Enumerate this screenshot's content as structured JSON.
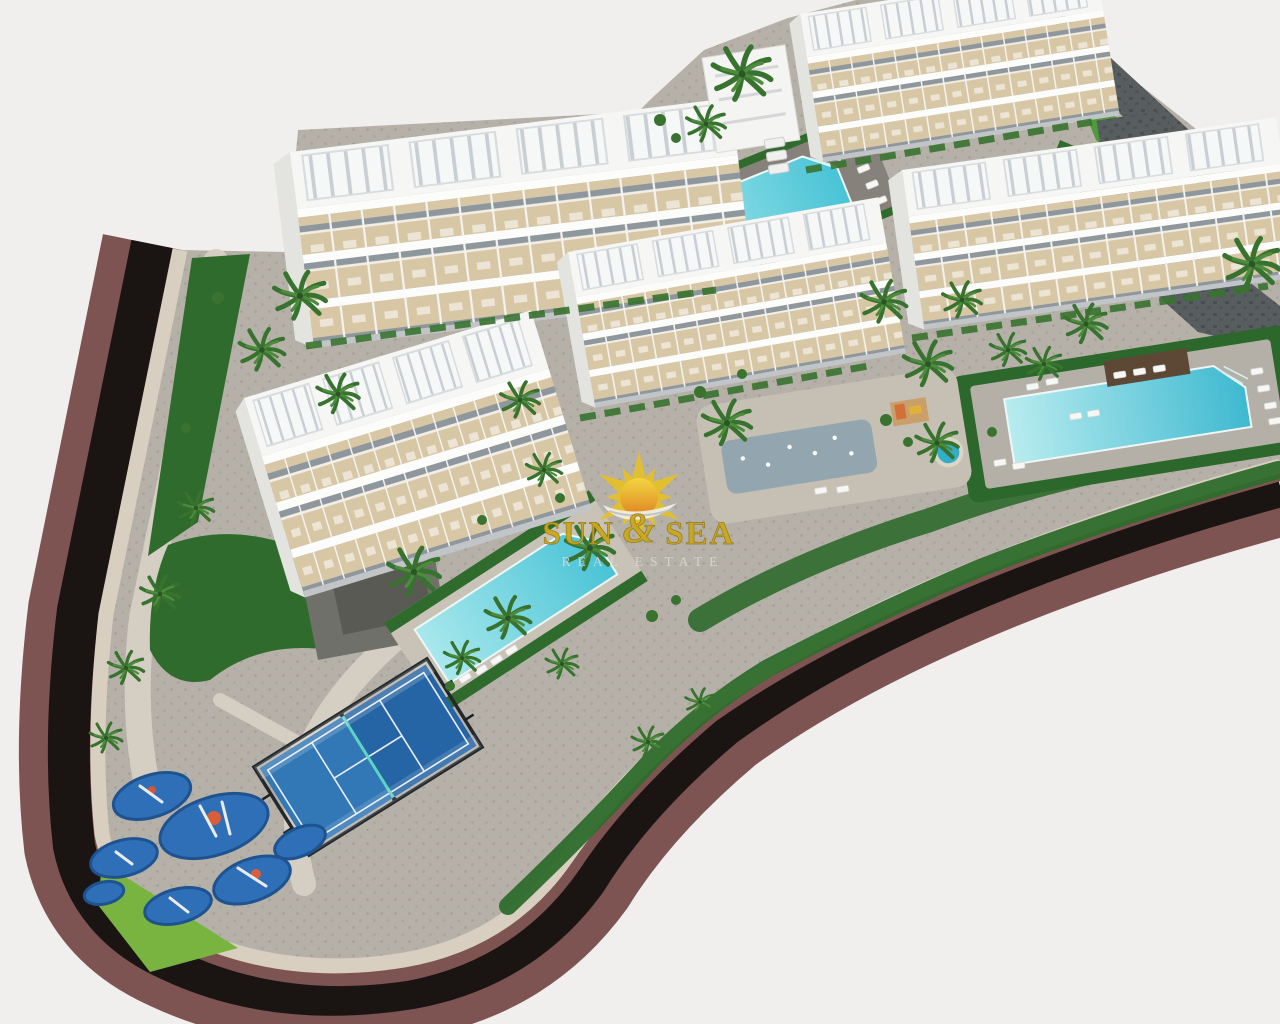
{
  "image": {
    "type": "3d-architectural-render",
    "view": "aerial",
    "subject": "New-build residential apartment complex with rooftop terraces, communal pools, padel court, playgrounds and perimeter road"
  },
  "watermark": {
    "brand_left": "SUN",
    "brand_amp": "&",
    "brand_right": "SEA",
    "tagline": "REAL ESTATE"
  },
  "colors": {
    "background": "#f1efee",
    "asphalt_road": "#1a1413",
    "sidewalk": "#7d5451",
    "boundary_wall": "#d9cfc0",
    "pavement": "#b6b1a8",
    "walkway": "#d6d0c5",
    "lawn": "#2f6b2c",
    "lawn_bright": "#79b440",
    "pool_water": "#49c3d6",
    "pool_water_light": "#a8e8ec",
    "building_white": "#f6f6f4",
    "terrace_beige": "#d8c7a5",
    "padel_blue": "#3277b6",
    "padel_blue_dark": "#2565a5",
    "playground_blue": "#2f6fb7",
    "stone_wall": "#585d5f",
    "palm_green": "#38722f",
    "sun_yellow": "#e5c02b",
    "sun_orange": "#e2821d",
    "brand_text": "#c9a81c",
    "tagline_text": "#dbdbd5"
  },
  "scene": {
    "buildings": [
      {
        "name": "apartment-block-northwest"
      },
      {
        "name": "apartment-block-north"
      },
      {
        "name": "apartment-block-east"
      },
      {
        "name": "apartment-block-central"
      },
      {
        "name": "apartment-block-west"
      }
    ],
    "pools": [
      {
        "name": "community-pool-north"
      },
      {
        "name": "community-pool-east"
      },
      {
        "name": "community-pool-central"
      }
    ],
    "amenities": [
      {
        "name": "padel-court"
      },
      {
        "name": "children-playground-west"
      },
      {
        "name": "splash-plaza-central"
      },
      {
        "name": "jacuzzi"
      }
    ],
    "landscape": [
      {
        "name": "palm-trees"
      },
      {
        "name": "lawns"
      },
      {
        "name": "perimeter-road"
      },
      {
        "name": "boundary-wall"
      }
    ]
  }
}
